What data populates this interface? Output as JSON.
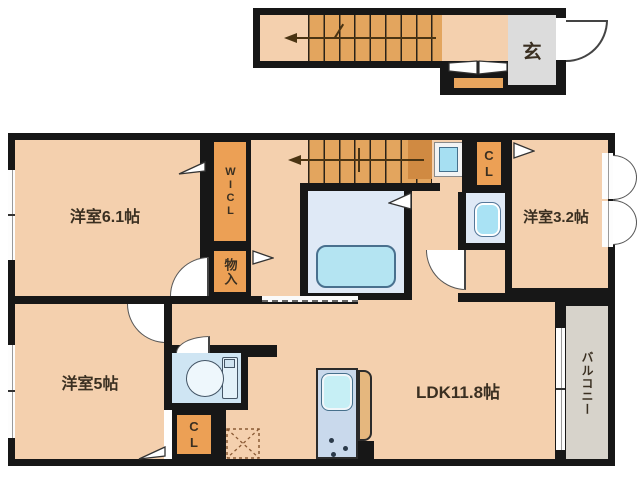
{
  "plan_title": "apartment floor plan",
  "upper_level": {
    "entrance": {
      "label": "玄"
    }
  },
  "rooms": {
    "west_room_6_1": {
      "label": "洋室6.1帖"
    },
    "wicl": {
      "label": "WICL"
    },
    "storage": {
      "label": "物入"
    },
    "closet_upper": {
      "label": "CL"
    },
    "west_room_3_2": {
      "label": "洋室3.2帖"
    },
    "west_room_5": {
      "label": "洋室5帖"
    },
    "closet_lower": {
      "label": "CL"
    },
    "ldk": {
      "label": "LDK11.8帖"
    },
    "balcony": {
      "label": "バルコニー"
    }
  },
  "colors": {
    "wall": "#171717",
    "room_fill": "#f4d0ae",
    "closet_fill": "#eca055",
    "stairs_fill": "#e3a55e",
    "entrance_fill": "#dcdcdc",
    "balcony_fill": "#d7d3cb",
    "bath_fill": "#dfe9f6",
    "bathtub_fill": "#b4e4f2",
    "fixture_blue": "#a9e2f4",
    "kitchen_fill": "#c9d9ec",
    "counter_fill": "#e5b77e"
  }
}
